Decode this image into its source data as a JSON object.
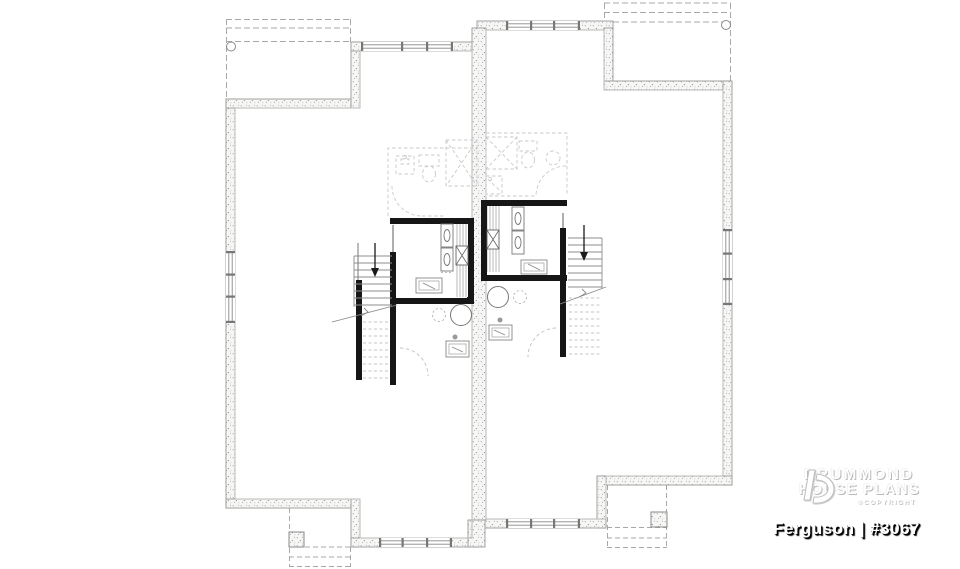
{
  "branding": {
    "line1": "DRUMMOND",
    "line2": "HOUSE PLANS",
    "copyright": "©COPYRIGHT",
    "plan_label": "Ferguson | #3067"
  },
  "colors": {
    "background": "#ffffff",
    "wall_outline": "#999999",
    "wall_fill": "#f6f6f4",
    "wall_stipple": "#8f8f8f",
    "interior_wall": "#161616",
    "thin_line": "#b8b8b8",
    "tread_line": "#8c8c8c",
    "dashed_overlay": "#c9c9c9",
    "deck_dash": "#a8a8a8",
    "arrow": "#1a1a1a",
    "logo_text": "#ffffff",
    "logo_shadow": "#b9b9b9",
    "plan_label_text": "#ffffff",
    "plan_label_shadow": "#000000"
  },
  "drawing": {
    "type": "basement-floor-plan",
    "units_mirrored": 2
  }
}
